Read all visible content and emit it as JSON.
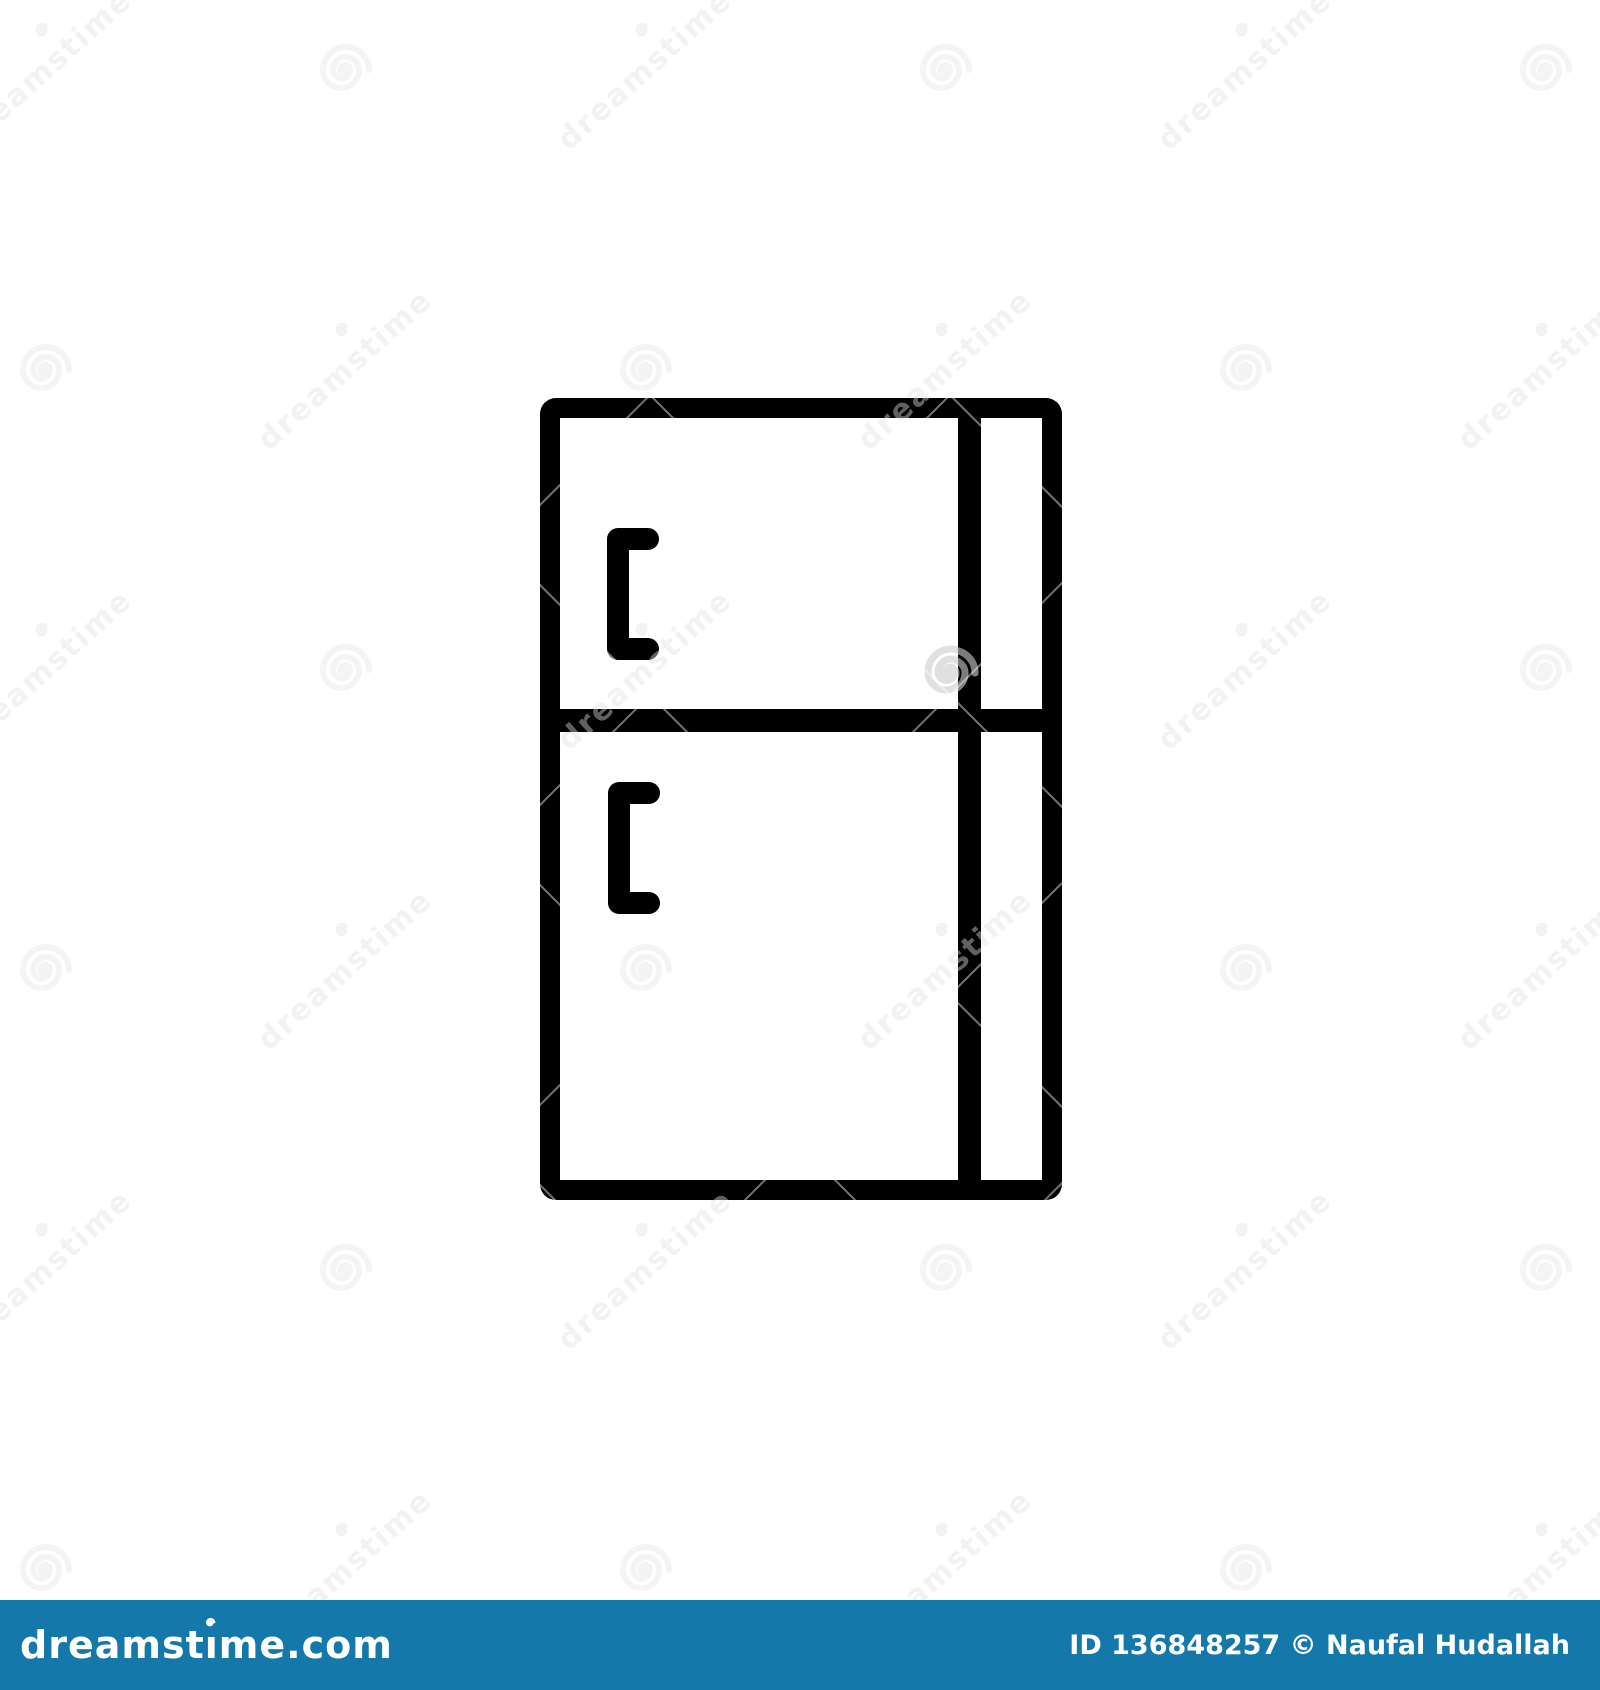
{
  "page": {
    "background": "#FFFFFF"
  },
  "icon": {
    "label": "refrigerator outline icon",
    "color": "#000000"
  },
  "watermark": {
    "text": "dreamstime"
  },
  "footer": {
    "background": "#1478AB",
    "logo_pre": "dreamst",
    "logo_i": "ı",
    "logo_post": "me.com",
    "credit": "ID 136848257 © Naufal Hudallah"
  }
}
